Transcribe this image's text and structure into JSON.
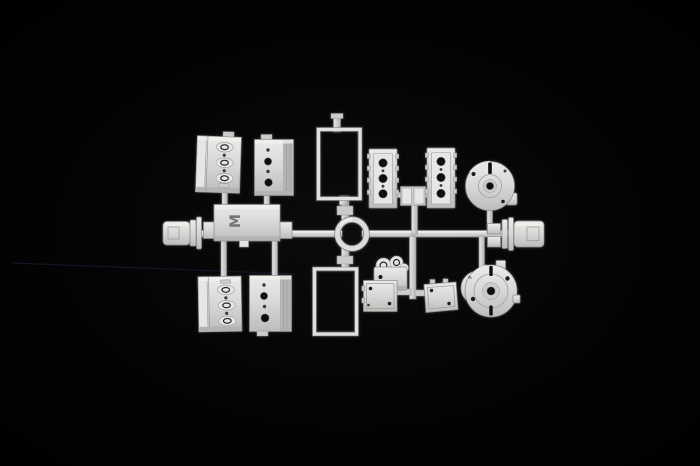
{
  "photo": {
    "background_color": "#000000",
    "subject": "white-plastic-model-kit-sprue-with-engine-parts",
    "scratch_line_color": "#17172a"
  },
  "sprue": {
    "plastic_color": "#d7d7d5",
    "highlight_color": "#f0f0ee",
    "shadow_color": "#8b8b89",
    "hole_color": "#070707",
    "marking_letter": "M",
    "parts": [
      "left-end-connector",
      "main-runner",
      "crankcase-half-upper-left",
      "crankcase-half-upper-right",
      "oil-pan",
      "crankcase-half-lower-left",
      "crankcase-half-lower-right",
      "frame-upper",
      "frame-lower",
      "pulley-ring",
      "cylinder-head-left",
      "cylinder-head-right",
      "head-bracket",
      "gearbox-end-cover",
      "right-end-connector",
      "timing-gear-cover",
      "engine-mount-left",
      "engine-mount-right",
      "bellhousing"
    ]
  }
}
